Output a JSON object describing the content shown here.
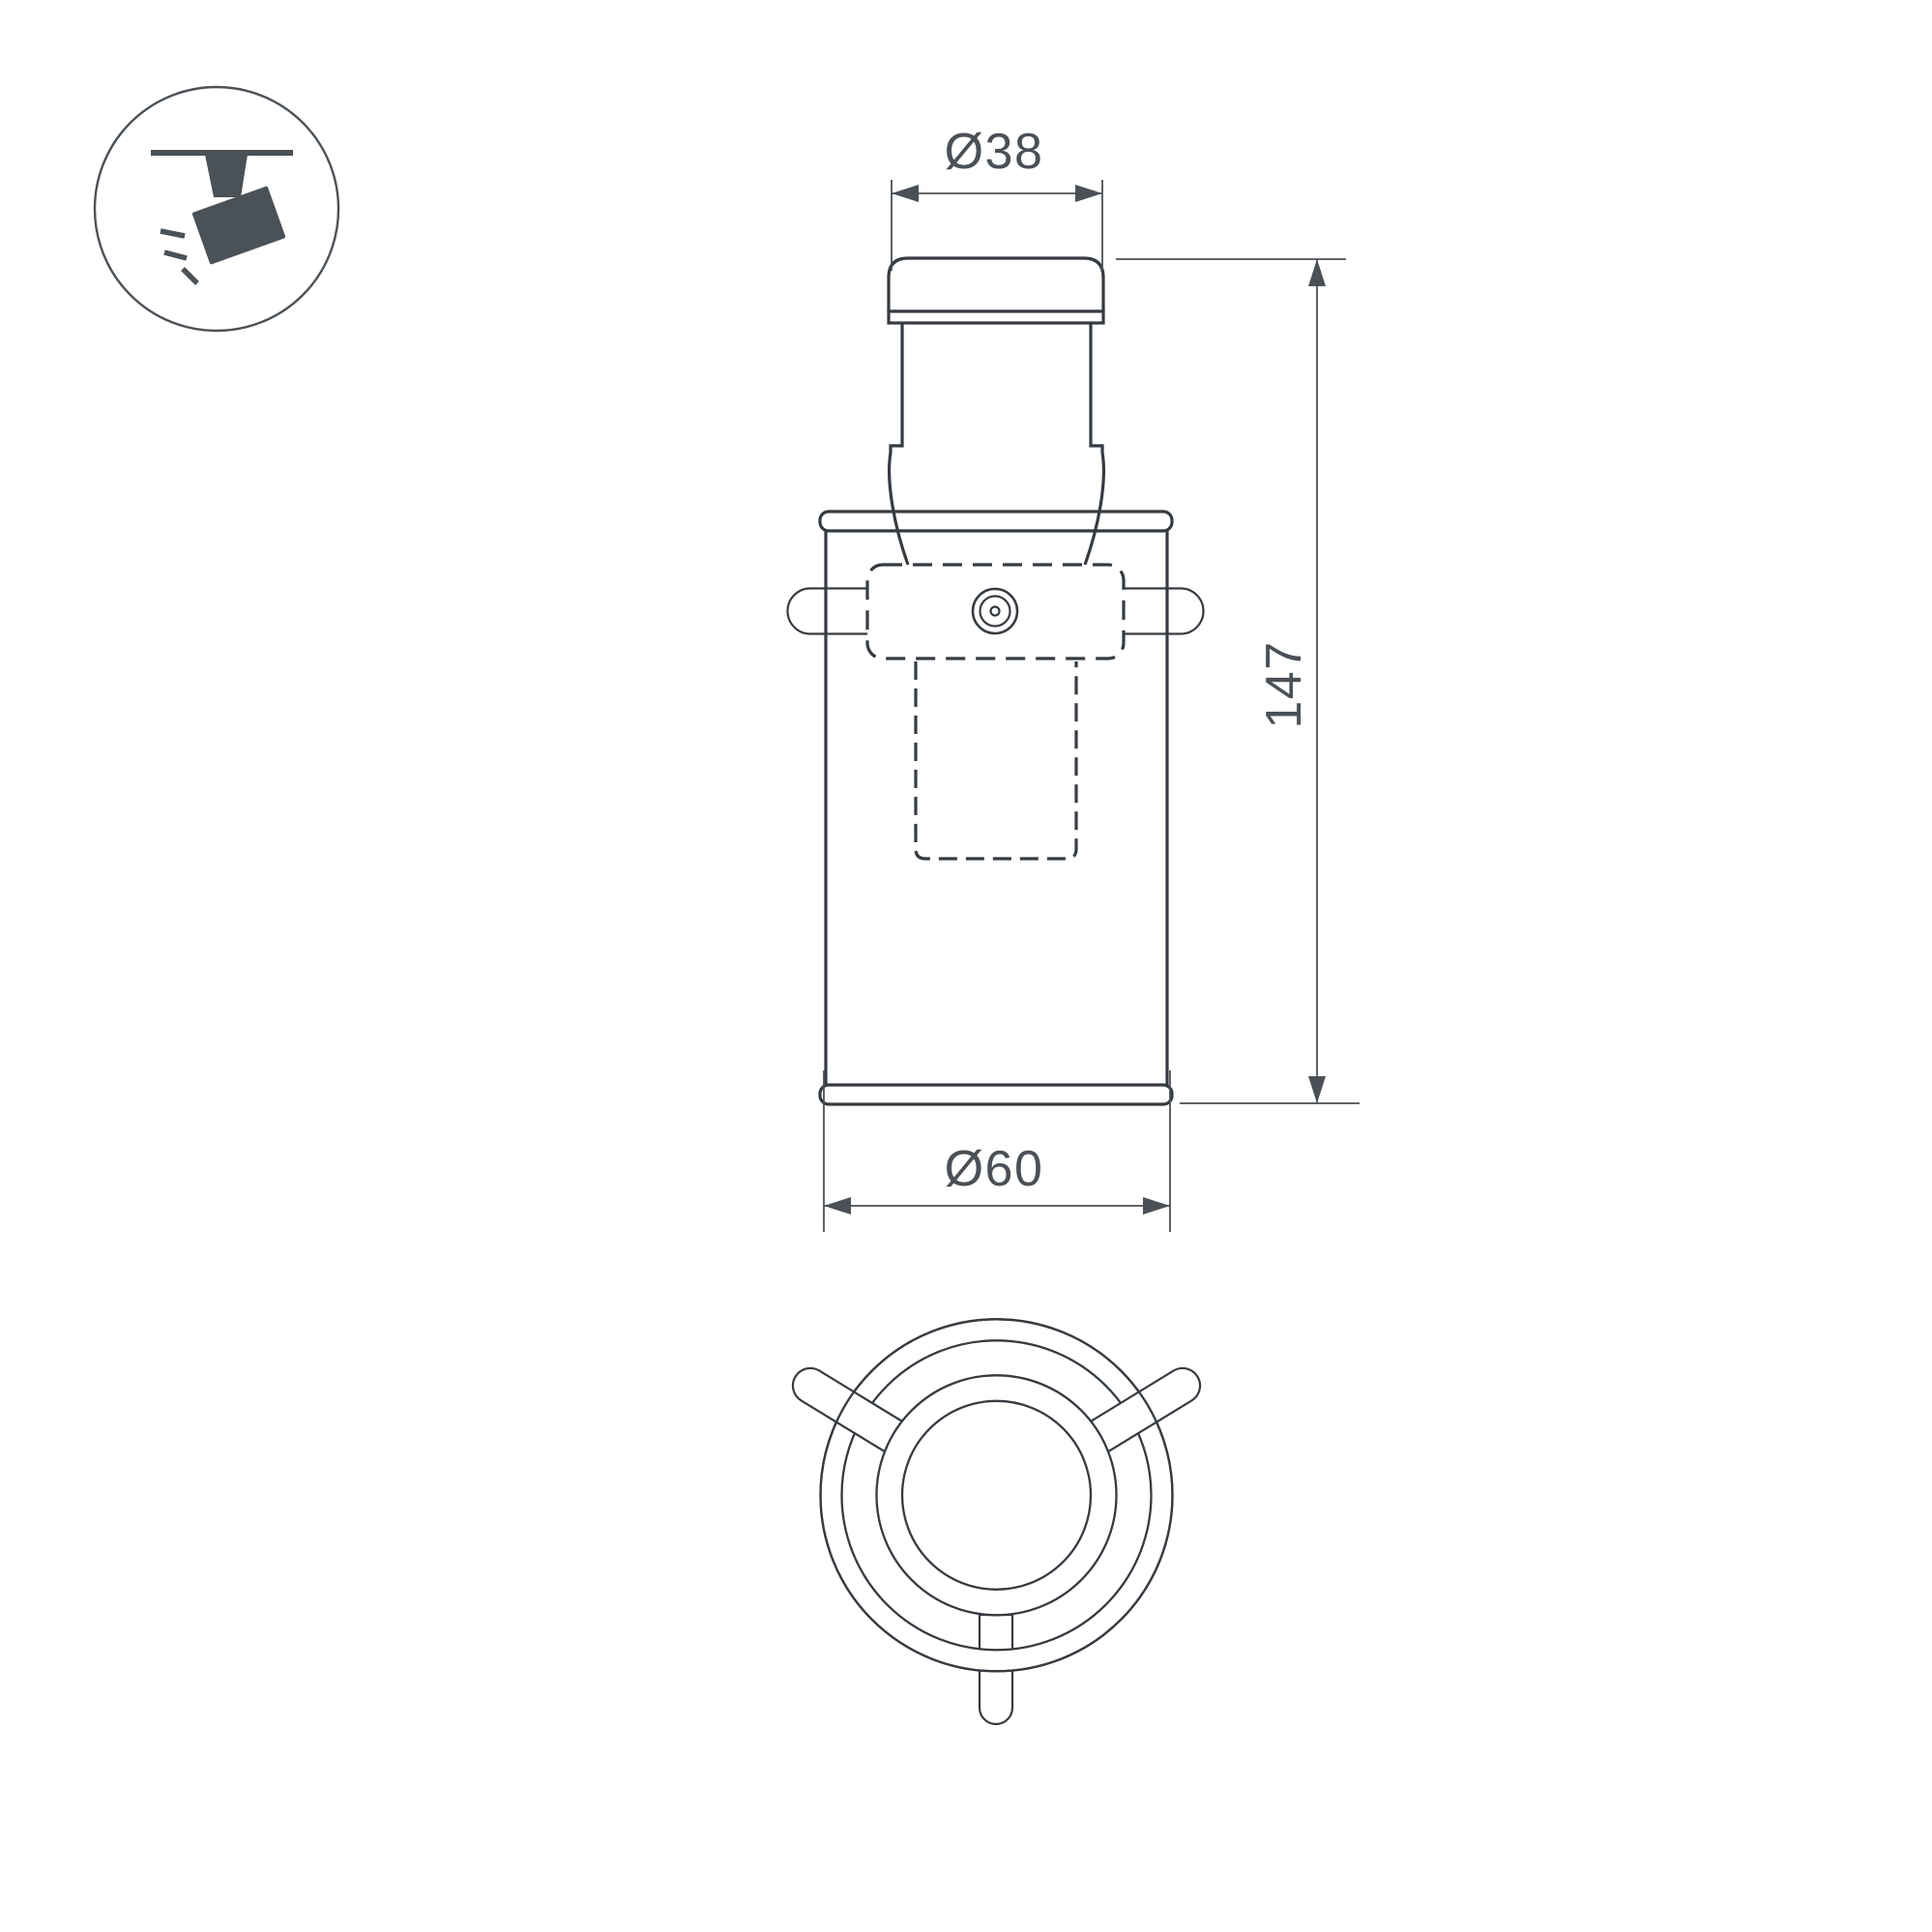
{
  "drawing": {
    "title": "track-spotlight-dimension-drawing",
    "background": "#ffffff",
    "line_color": "#353b41",
    "dim_color": "#4a5056",
    "icon_color": "#4a5157"
  },
  "badge": {
    "icon": "track-spotlight-icon"
  },
  "dimensions": {
    "top_diameter": {
      "label": "Ø38",
      "value": 38
    },
    "height": {
      "label": "147",
      "value": 147
    },
    "bottom_diameter": {
      "label": "Ø60",
      "value": 60
    }
  }
}
